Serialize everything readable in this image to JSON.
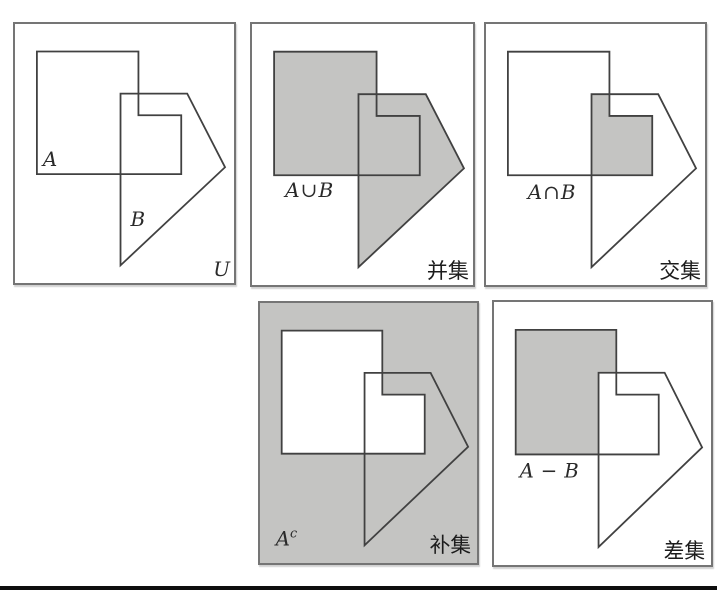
{
  "colors": {
    "shade": "#c4c4c2",
    "outline": "#414141",
    "panel_border": "#757575",
    "text": "#1c1c1c",
    "rule": "#0e0e0e"
  },
  "panels": {
    "universe": {
      "label_a": "A",
      "label_b": "B",
      "label_u": "U"
    },
    "union": {
      "expr_a": "A",
      "expr_op": "∪",
      "expr_b": "B",
      "caption": "并集"
    },
    "intersection": {
      "expr_a": "A",
      "expr_op": "∩",
      "expr_b": "B",
      "caption": "交集"
    },
    "complement": {
      "expr_base": "A",
      "expr_sup": "c",
      "caption": "补集"
    },
    "difference": {
      "expr_a": "A",
      "expr_op": "−",
      "expr_b": "B",
      "caption": "差集"
    }
  }
}
